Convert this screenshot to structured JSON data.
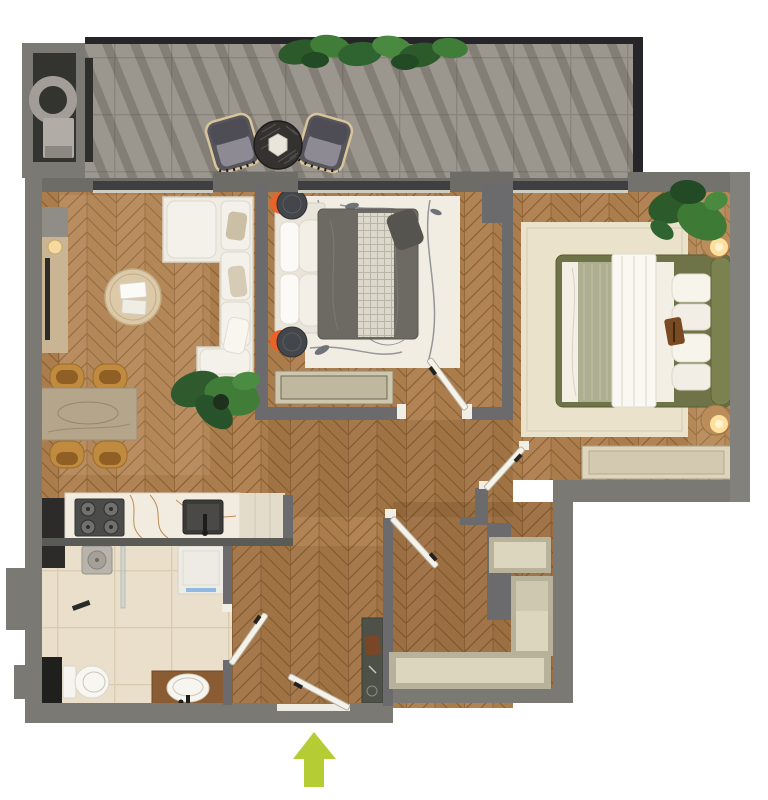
{
  "scene": {
    "type": "apartment floor plan, 3d top-down render",
    "entrance": {
      "marker": "green up arrow",
      "location": "bottom-center"
    }
  },
  "palette": {
    "wall": "#7b7974",
    "wall_partition": "#6b6b6d",
    "wall_band": "#6e6c67",
    "window": "#3d3f43",
    "window_sill": "#cfccc2",
    "balcony_frame": "#26262a",
    "balcony_tile": "#9c978e",
    "bath_tile": "#eadfca",
    "wood_base": "#b28354",
    "wood_line": "#8a6134",
    "marble_rug": "#f1ede3",
    "cream_rug": "#ebe2cb",
    "sofa": "#efece4",
    "duvet_gray": "#6d6a64",
    "bed_frame_olive": "#6f7448",
    "accent_orange": "#e8622a",
    "plant_dark": "#2c5a2b",
    "plant_light": "#3f7d38",
    "door": "#f5f2e9",
    "arrow": "#b5cc34",
    "counter_marble": "#f2ece0",
    "vanity_wood": "#8a5c33",
    "dark_fixture": "#2c2b29"
  },
  "rooms": {
    "balcony": {
      "label": "balcony",
      "items": [
        "planter greenery",
        "lounge chair",
        "lounge chair",
        "round table",
        "utility shaft"
      ]
    },
    "living_room": {
      "label": "living room",
      "items": [
        "tv console",
        "table lamp",
        "corner sofa",
        "round coffee table",
        "dining table",
        "four dining chairs",
        "potted plant"
      ]
    },
    "kitchen": {
      "label": "kitchen",
      "items": [
        "marble countertop",
        "cooktop 4 burners",
        "sink",
        "tall dark cabinet"
      ]
    },
    "bedroom_1": {
      "label": "bedroom 1",
      "items": [
        "double bed",
        "two round nightstands",
        "marble area rug",
        "storage bench"
      ]
    },
    "bedroom_2": {
      "label": "bedroom 2",
      "items": [
        "double bed olive frame",
        "two nightstands with lamps",
        "cream area rug",
        "storage bench",
        "potted plants"
      ]
    },
    "bathroom": {
      "label": "bathroom",
      "items": [
        "shower",
        "washing machine",
        "wall-hung toilet",
        "vanity with sink"
      ]
    },
    "hallway": {
      "label": "entrance hall",
      "items": [
        "entry console",
        "entry door",
        "interior doors"
      ]
    },
    "storage": {
      "label": "walk-in closet",
      "items": [
        "shelf niche",
        "tall shelf niche",
        "long shelf"
      ]
    }
  }
}
